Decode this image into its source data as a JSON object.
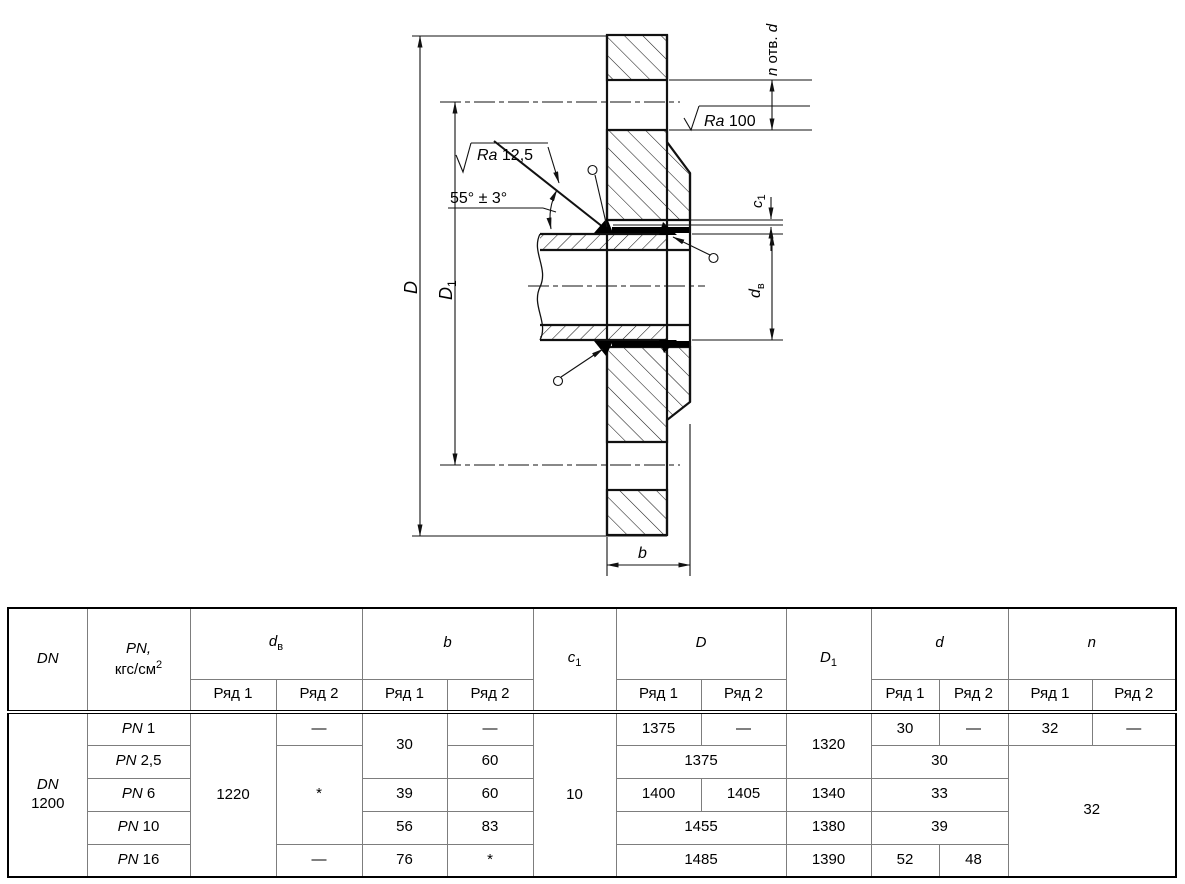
{
  "drawing": {
    "dim_D": "D",
    "dim_D1_main": "D",
    "dim_D1_sub": "1",
    "holes_n": "n",
    "holes_mid": " отв. ",
    "holes_d": "d",
    "ra_top_prefix": "Ra",
    "ra_top_value": " 100",
    "ra_bevel_prefix": "Ra",
    "ra_bevel_value": " 12,5",
    "angle": "55° ± 3°",
    "c1_main": "c",
    "c1_sub": "1",
    "dv_main": "d",
    "dv_sub": "в",
    "b": "b"
  },
  "table": {
    "header": {
      "dn": "DN",
      "pn_line1": "PN,",
      "pn_line2_base": "кгс/см",
      "pn_line2_sup": "2",
      "dv_main": "d",
      "dv_sub": "в",
      "b": "b",
      "c1_main": "c",
      "c1_sub": "1",
      "D": "D",
      "D1_main": "D",
      "D1_sub": "1",
      "d": "d",
      "n": "n",
      "row1": "Ряд 1",
      "row2": "Ряд 2"
    },
    "body": {
      "dn_line1": "DN",
      "dn_line2": "1200",
      "pn_prefix": "PN",
      "pn_values": [
        "1",
        "2,5",
        "6",
        "10",
        "16"
      ],
      "dv_row1": "1220",
      "dv_row2_pn1": "—",
      "dv_row2_pn25_pn10": "*",
      "dv_row2_pn16": "—",
      "b_row1_pn1_pn25": "30",
      "b_row1_pn6": "39",
      "b_row1_pn10": "56",
      "b_row1_pn16": "76",
      "b_row2_pn1": "—",
      "b_row2_pn25": "60",
      "b_row2_pn6": "60",
      "b_row2_pn10": "83",
      "b_row2_pn16": "*",
      "c1": "10",
      "D_row1_pn1": "1375",
      "D_row2_pn1": "—",
      "D_pn25": "1375",
      "D_row1_pn6": "1400",
      "D_row2_pn6": "1405",
      "D_pn10": "1455",
      "D_pn16": "1485",
      "D1_pn1_pn25": "1320",
      "D1_pn6": "1340",
      "D1_pn10": "1380",
      "D1_pn16": "1390",
      "d_row1_pn1": "30",
      "d_row2_pn1": "—",
      "d_pn25": "30",
      "d_pn6": "33",
      "d_pn10": "39",
      "d_row1_pn16": "52",
      "d_row2_pn16": "48",
      "n_row1_pn1": "32",
      "n_row2_pn1": "—",
      "n_rest": "32"
    }
  }
}
